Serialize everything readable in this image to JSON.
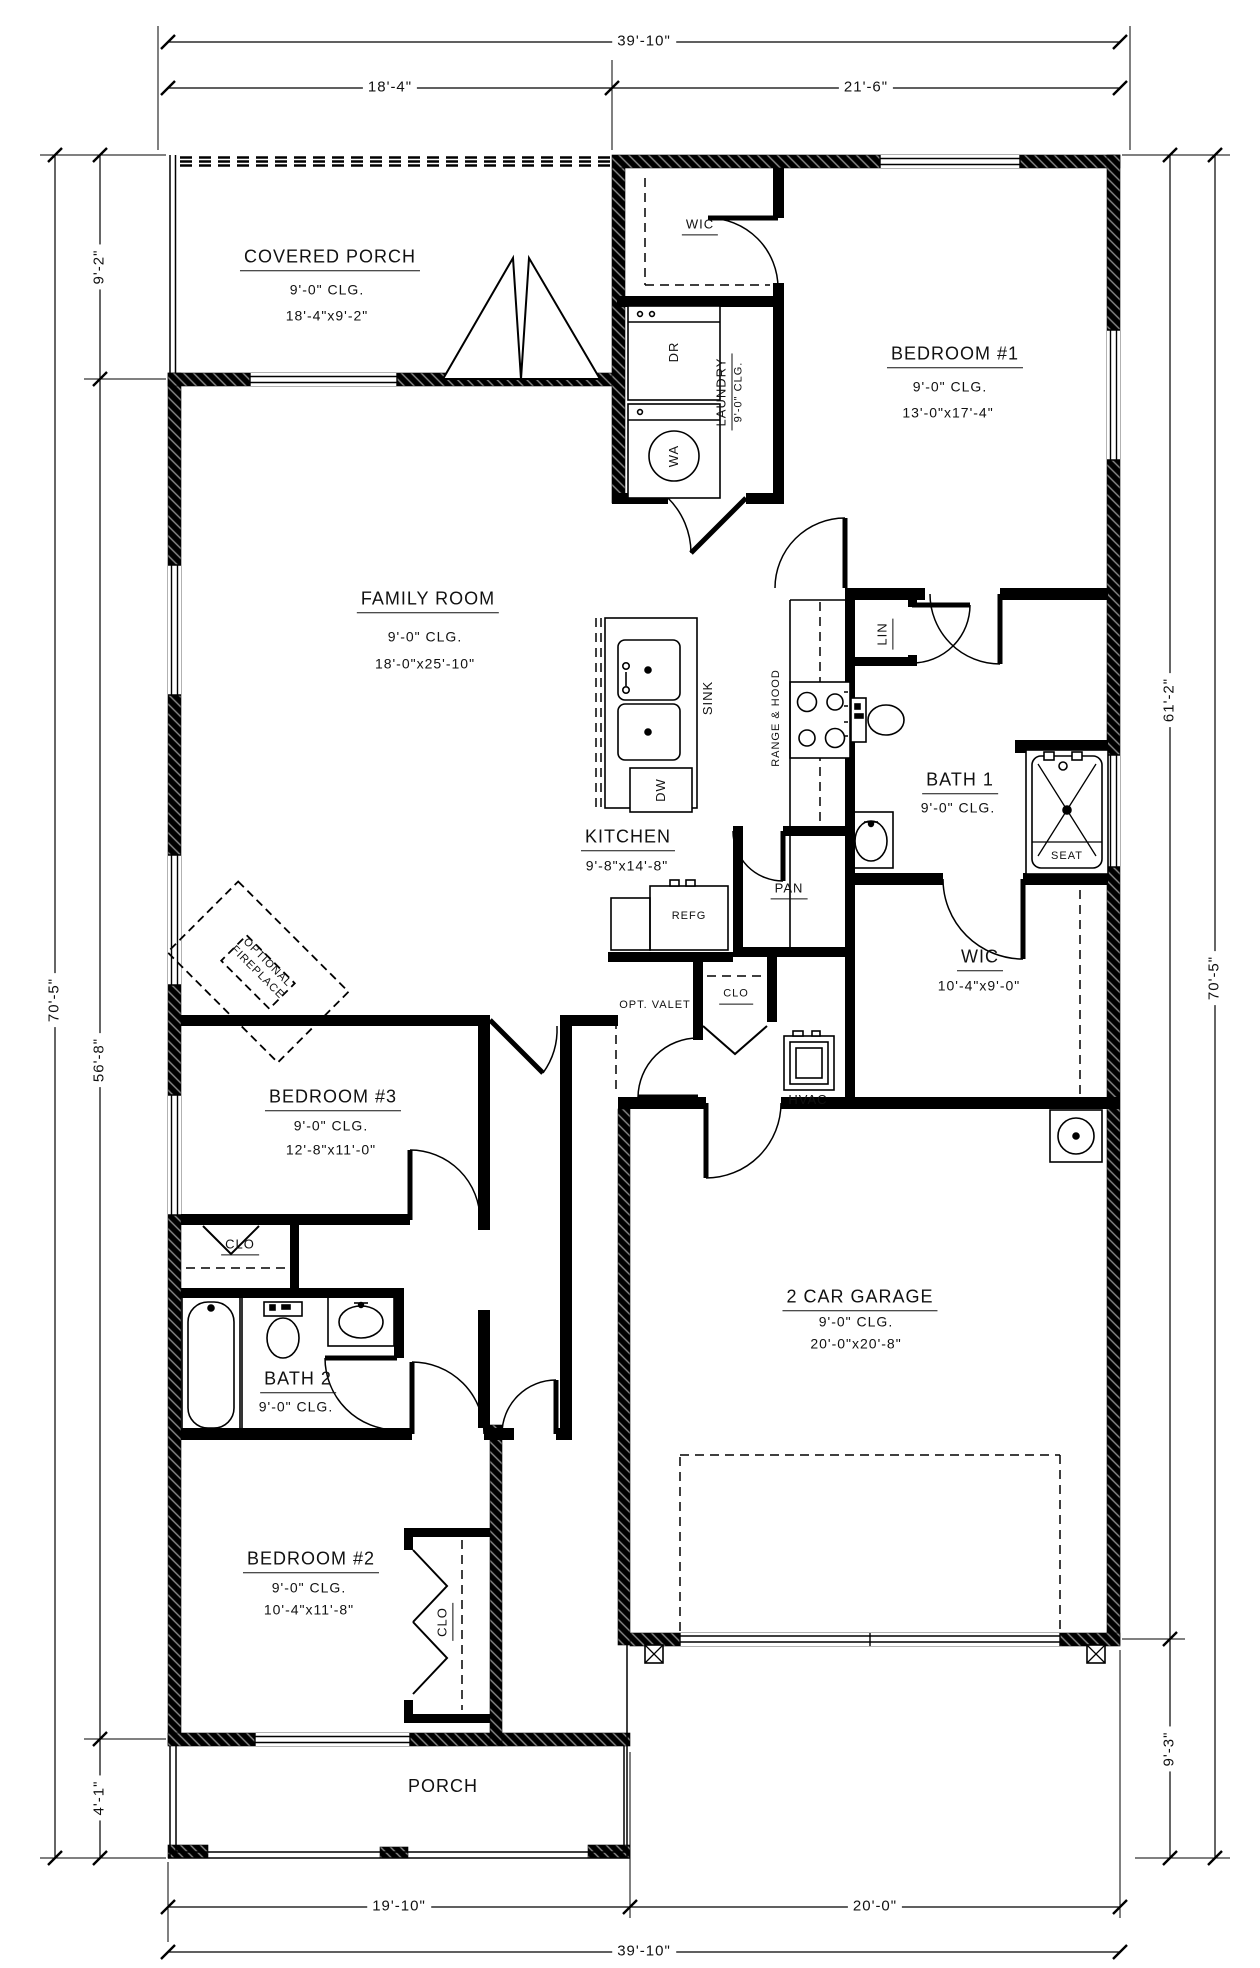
{
  "title": "floor-plan",
  "dims": {
    "top_overall": "39'-10\"",
    "top_seg_left": "18'-4\"",
    "top_seg_right": "21'-6\"",
    "left_porch": "9'-2\"",
    "left_overall": "70'-5\"",
    "left_main": "56'-8\"",
    "left_lower": "4'-1\"",
    "right_upper": "61'-2\"",
    "right_overall": "70'-5\"",
    "right_lower": "9'-3\"",
    "bottom_seg_left": "19'-10\"",
    "bottom_seg_right": "20'-0\"",
    "bottom_overall": "39'-10\""
  },
  "rooms": {
    "covered_porch": {
      "name": "COVERED PORCH",
      "clg": "9'-0\" CLG.",
      "size": "18'-4\"x9'-2\""
    },
    "wic_bed1": {
      "name": "WIC"
    },
    "laundry": {
      "name": "LAUNDRY",
      "clg": "9'-0\" CLG."
    },
    "bedroom1": {
      "name": "BEDROOM #1",
      "clg": "9'-0\" CLG.",
      "size": "13'-0\"x17'-4\""
    },
    "family_room": {
      "name": "FAMILY ROOM",
      "clg": "9'-0\" CLG.",
      "size": "18'-0\"x25'-10\""
    },
    "kitchen": {
      "name": "KITCHEN",
      "size": "9'-8\"x14'-8\""
    },
    "pantry": {
      "name": "PAN"
    },
    "linen": {
      "name": "LIN"
    },
    "bath1": {
      "name": "BATH 1",
      "clg": "9'-0\" CLG."
    },
    "wic_master": {
      "name": "WIC",
      "size": "10'-4\"x9'-0\""
    },
    "opt_valet": {
      "name": "OPT. VALET"
    },
    "clo_hall": {
      "name": "CLO"
    },
    "hvac": {
      "name": "HVAC"
    },
    "optional_fireplace": {
      "line1": "OPTIONAL",
      "line2": "FIREPLACE"
    },
    "bedroom3": {
      "name": "BEDROOM #3",
      "clg": "9'-0\" CLG.",
      "size": "12'-8\"x11'-0\""
    },
    "clo_bed3": {
      "name": "CLO"
    },
    "bath2": {
      "name": "BATH 2",
      "clg": "9'-0\" CLG."
    },
    "bedroom2": {
      "name": "BEDROOM #2",
      "clg": "9'-0\" CLG.",
      "size": "10'-4\"x11'-8\""
    },
    "clo_bed2": {
      "name": "CLO"
    },
    "porch": {
      "name": "PORCH"
    },
    "garage": {
      "name": "2 CAR GARAGE",
      "clg": "9'-0\" CLG.",
      "size": "20'-0\"x20'-8\""
    }
  },
  "fixtures": {
    "dryer": "DR",
    "washer": "WA",
    "sink": "SINK",
    "dishwasher": "DW",
    "range_hood": "RANGE & HOOD",
    "refrigerator": "REFG",
    "seat": "SEAT"
  }
}
